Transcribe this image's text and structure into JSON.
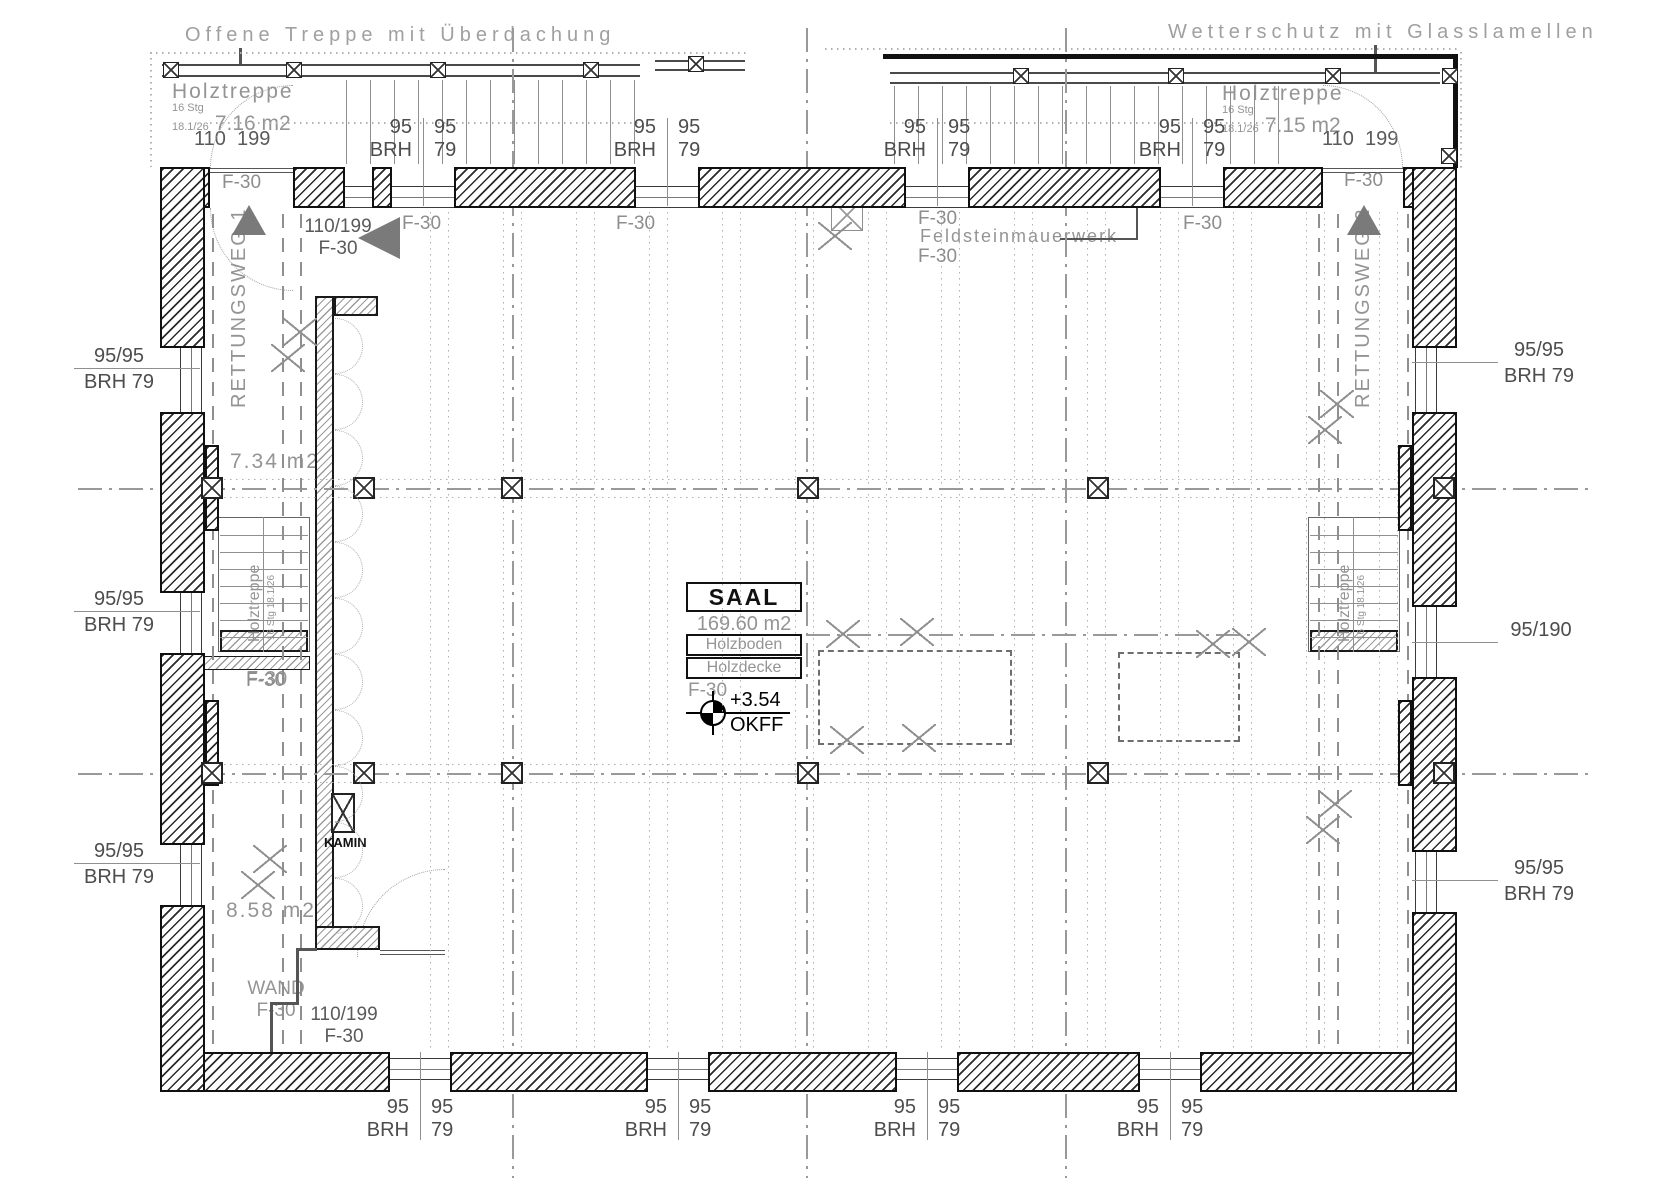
{
  "titles": {
    "left": "Offene Treppe mit Überdachung",
    "right": "Wetterschutz mit Glasslamellen"
  },
  "canopy_left": {
    "name": "Holztreppe",
    "steps": "16 Stg",
    "ratio": "18.1/26",
    "area": "7.16 m2",
    "door_w": "110",
    "door_h": "199"
  },
  "canopy_right": {
    "name": "Holztreppe",
    "steps": "16 Stg",
    "ratio": "18.1/26",
    "area": "7.15 m2",
    "door_w": "110",
    "door_h": "199"
  },
  "stairs": {
    "left": {
      "name": "Holztreppe",
      "sub": "16 Stg 18.1/26",
      "fire": "F-30"
    },
    "right": {
      "name": "Holztreppe",
      "sub": "16 Stg 18.1/26"
    }
  },
  "escape": {
    "route1": "RETTUNGSWEG 1",
    "route2": "RETTUNGSWEG 2"
  },
  "room": {
    "name": "SAAL",
    "area": "169.60 m2",
    "floor": "Holzboden",
    "ceiling": "Holzdecke",
    "fire": "F-30",
    "level": "+3.54",
    "level_ref": "OKFF"
  },
  "areas": {
    "upper": "7.34 m2",
    "lower": "8.58 m2"
  },
  "labels": {
    "f30": "F-30",
    "win_w": "95",
    "win_h": "95",
    "brh": "BRH",
    "sill": "79",
    "side_window": "95/95",
    "side_brh": "BRH 79",
    "side_door": "95/190",
    "door_size": "110/199",
    "wand": "WAND",
    "kamin": "KAMIN",
    "masonry": "Feldsteinmauerwerk"
  },
  "colors": {
    "wall": "#101010",
    "annotation": "#949494",
    "dimension": "#4d4d4d",
    "arrow": "#7a7a7a"
  }
}
